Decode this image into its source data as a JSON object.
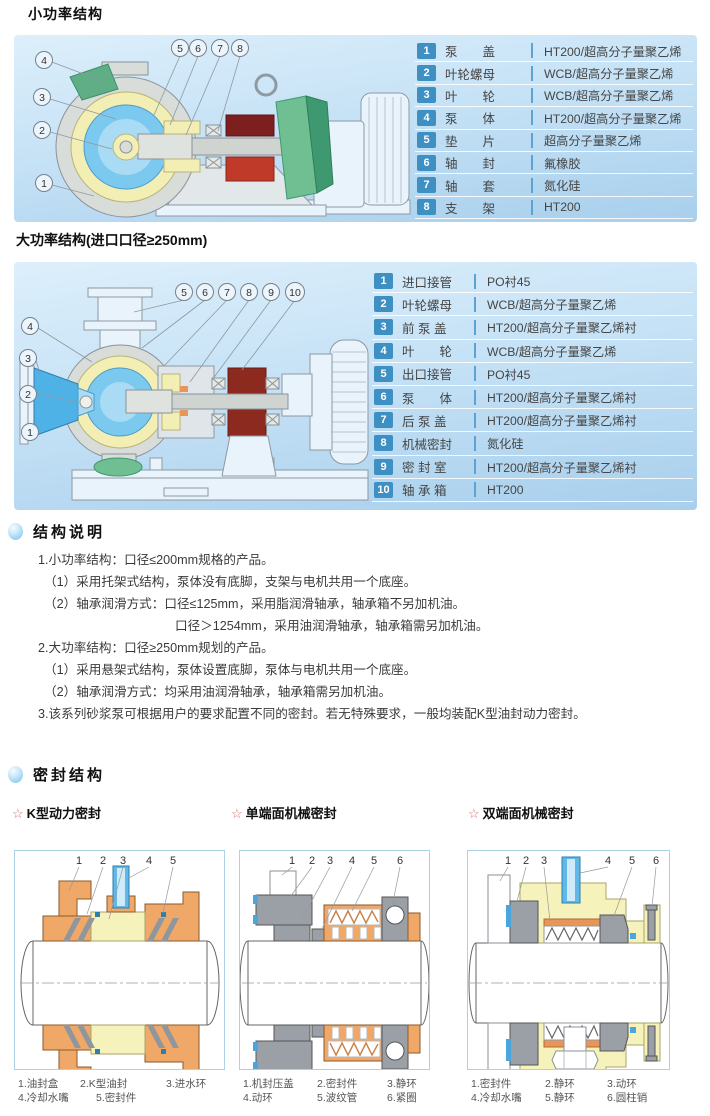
{
  "sections": {
    "small": {
      "title": "小功率结构",
      "callouts_top": [
        "5",
        "6",
        "7",
        "8"
      ],
      "callouts_left": [
        "4",
        "3",
        "2",
        "1"
      ],
      "table": [
        {
          "num": "1",
          "name": "泵　　盖",
          "material": "HT200/超高分子量聚乙烯"
        },
        {
          "num": "2",
          "name": "叶轮螺母",
          "material": "WCB/超高分子量聚乙烯"
        },
        {
          "num": "3",
          "name": "叶　　轮",
          "material": "WCB/超高分子量聚乙烯"
        },
        {
          "num": "4",
          "name": "泵　　体",
          "material": "HT200/超高分子量聚乙烯"
        },
        {
          "num": "5",
          "name": "垫　　片",
          "material": "超高分子量聚乙烯"
        },
        {
          "num": "6",
          "name": "轴　　封",
          "material": "氟橡胶"
        },
        {
          "num": "7",
          "name": "轴　　套",
          "material": "氮化硅"
        },
        {
          "num": "8",
          "name": "支　　架",
          "material": "HT200"
        }
      ]
    },
    "large": {
      "title": "大功率结构(进口口径≥250mm)",
      "callouts_top": [
        "5",
        "6",
        "7",
        "8",
        "9",
        "10"
      ],
      "callouts_left": [
        "4",
        "3",
        "2",
        "1"
      ],
      "table": [
        {
          "num": "1",
          "name": "进口接管",
          "material": "PO衬45"
        },
        {
          "num": "2",
          "name": "叶轮螺母",
          "material": "WCB/超高分子量聚乙烯"
        },
        {
          "num": "3",
          "name": "前 泵 盖",
          "material": "HT200/超高分子量聚乙烯衬"
        },
        {
          "num": "4",
          "name": "叶　　轮",
          "material": "WCB/超高分子量聚乙烯"
        },
        {
          "num": "5",
          "name": "出口接管",
          "material": "PO衬45"
        },
        {
          "num": "6",
          "name": "泵　　体",
          "material": "HT200/超高分子量聚乙烯衬"
        },
        {
          "num": "7",
          "name": "后 泵 盖",
          "material": "HT200/超高分子量聚乙烯衬"
        },
        {
          "num": "8",
          "name": "机械密封",
          "material": "氮化硅"
        },
        {
          "num": "9",
          "name": "密 封 室",
          "material": "HT200/超高分子量聚乙烯衬"
        },
        {
          "num": "10",
          "name": "轴 承 箱",
          "material": "HT200"
        }
      ]
    },
    "notes": {
      "title": "结构说明",
      "lines": [
        "1.小功率结构：口径≤200mm规格的产品。",
        "（1）采用托架式结构，泵体没有底脚，支架与电机共用一个底座。",
        "（2）轴承润滑方式：口径≤125mm，采用脂润滑轴承，轴承箱不另加机油。",
        "口径＞1254mm，采用油润滑轴承，轴承箱需另加机油。",
        "2.大功率结构：口径≥250mm规划的产品。",
        "（1）采用悬架式结构，泵体设置底脚，泵体与电机共用一个底座。",
        "（2）轴承润滑方式：均采用油润滑轴承，轴承箱需另加机油。",
        "3.该系列砂浆泵可根据用户的要求配置不同的密封。若无特殊要求，一般均装配K型油封动力密封。"
      ]
    },
    "seals": {
      "title": "密封结构",
      "items": [
        {
          "star": "☆",
          "title": "K型动力密封",
          "callouts": [
            "1",
            "2",
            "3",
            "4",
            "5"
          ],
          "caption": [
            [
              "1.油封盒",
              "2.K型油封",
              "3.进水环"
            ],
            [
              "4.冷却水嘴",
              "5.密封件",
              ""
            ]
          ]
        },
        {
          "star": "☆",
          "title": "单端面机械密封",
          "callouts": [
            "1",
            "2",
            "3",
            "4",
            "5",
            "6"
          ],
          "caption": [
            [
              "1.机封压盖",
              "2.密封件",
              "3.静环"
            ],
            [
              "4.动环",
              "5.波纹管",
              "6.紧圈"
            ]
          ]
        },
        {
          "star": "☆",
          "title": "双端面机械密封",
          "callouts": [
            "1",
            "2",
            "3",
            "4",
            "5",
            "6"
          ],
          "caption": [
            [
              "1.密封件",
              "2.静环",
              "3.动环"
            ],
            [
              "4.冷却水嘴",
              "5.静环",
              "6.圆柱销"
            ]
          ]
        }
      ]
    }
  },
  "colors": {
    "chip_blue": "#3e8fc2",
    "divider_blue": "#5ca3d2",
    "star_red": "#e46a6a",
    "panel_top": "#ddeffb",
    "panel_bottom": "#a8cfec",
    "seal_border": "#aad2e6"
  }
}
